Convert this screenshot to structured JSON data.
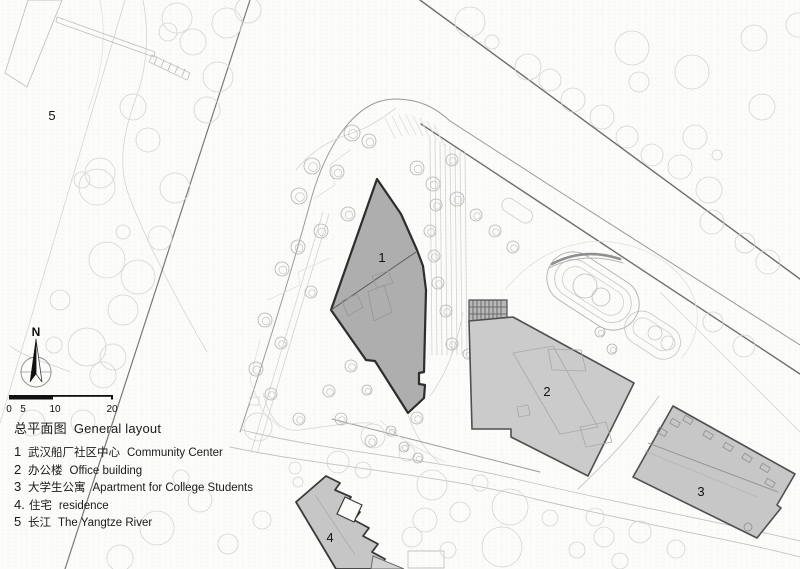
{
  "plan": {
    "labels": {
      "b1": "1",
      "b2": "2",
      "b3": "3",
      "b4": "4",
      "river": "5"
    }
  },
  "north": {
    "label": "N"
  },
  "scale_bar": {
    "ticks": [
      "0",
      "5",
      "10",
      "20"
    ]
  },
  "legend": {
    "title_zh": "总平面图",
    "title_en": "General layout",
    "items": [
      {
        "num": "1",
        "zh": "武汉船厂社区中心",
        "en": "Community Center"
      },
      {
        "num": "2",
        "zh": "办公楼",
        "en": "Office building"
      },
      {
        "num": "3",
        "zh": "大学生公寓",
        "en": "Apartment for College Students"
      },
      {
        "num": "4.",
        "zh": "住宅",
        "en": "residence"
      },
      {
        "num": "5",
        "zh": "长江",
        "en": "The Yangtze River"
      }
    ]
  },
  "colors": {
    "building_fill_dark": "#aeaeae",
    "building_fill_light": "#cbcbcb",
    "building_outline_dark": "#2d2d2d",
    "building_outline_light": "#4f4f4f",
    "street_line": "#6e6e6e",
    "paper": "#fcfcfb"
  }
}
